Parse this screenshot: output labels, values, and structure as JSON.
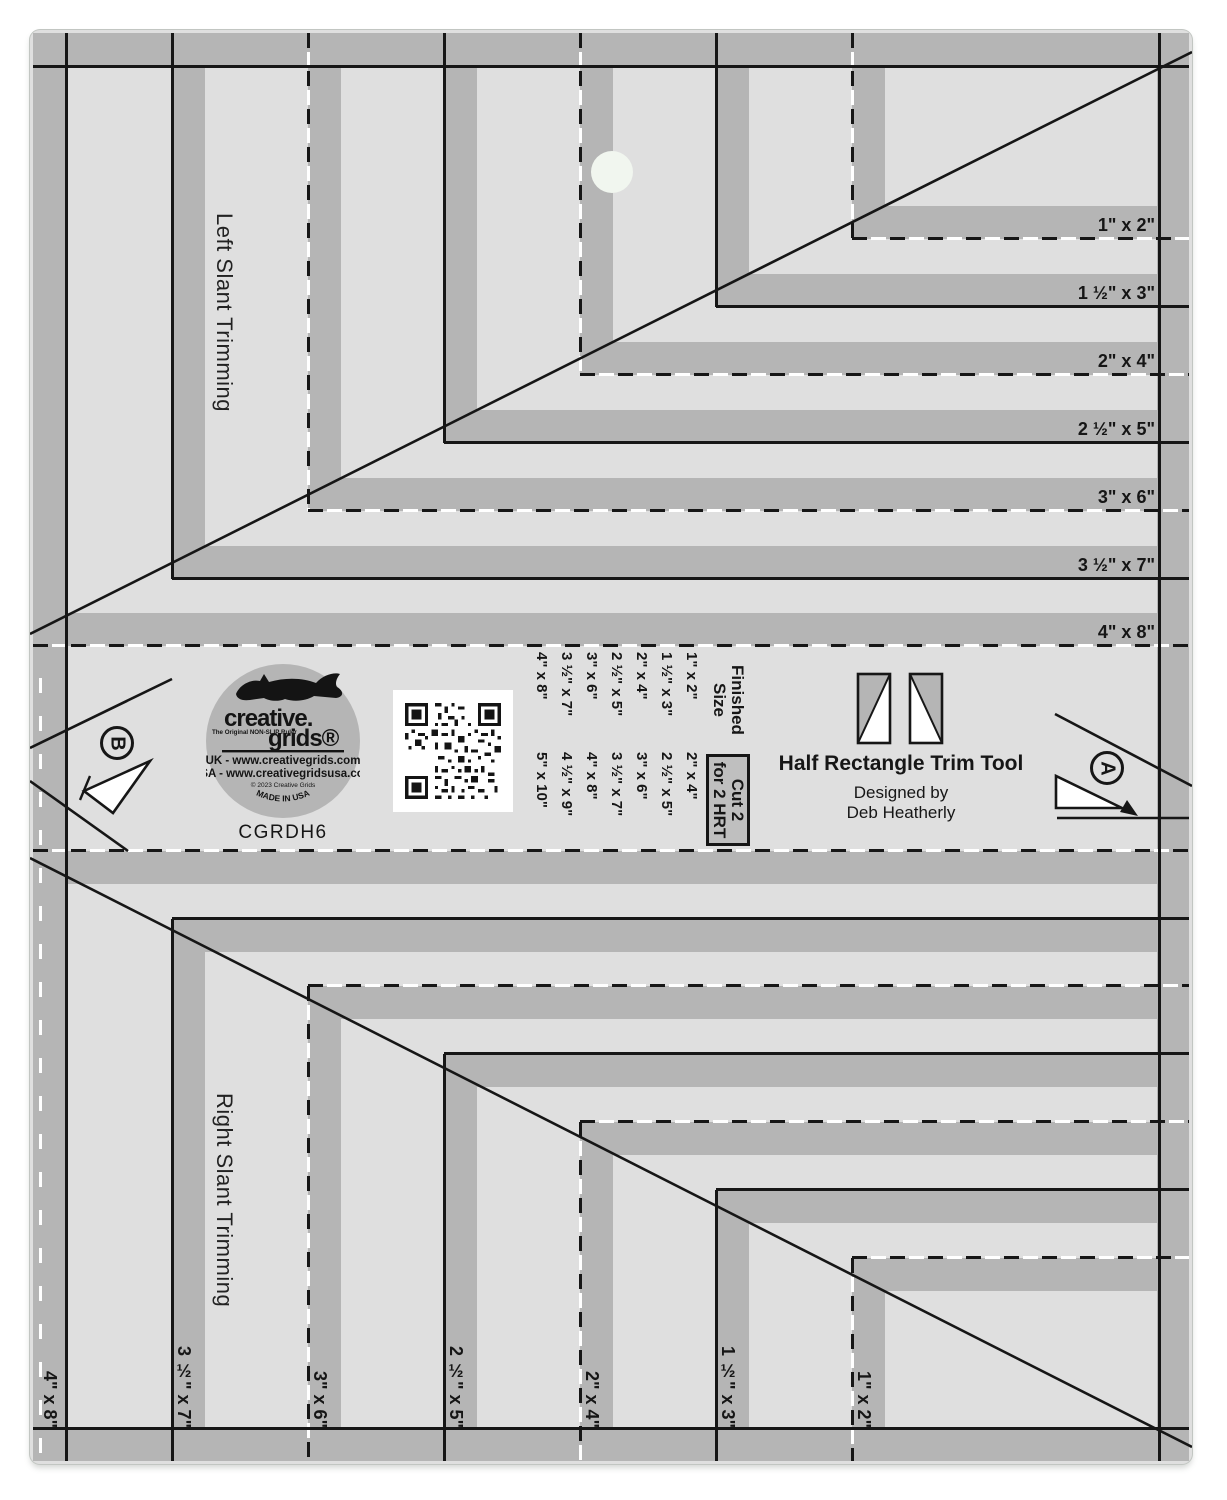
{
  "colors": {
    "body": "#dfdfdf",
    "band": "#b5b5b5",
    "line": "#161616",
    "white": "#ffffff",
    "hole": "#f1f6ef"
  },
  "sections": {
    "left_slant": "Left Slant Trimming",
    "right_slant": "Right Slant Trimming"
  },
  "markers": {
    "a": "A",
    "b": "B"
  },
  "top_labels": [
    "1\" x 2\"",
    "1 ½\" x 3\"",
    "2\" x 4\"",
    "2 ½\" x 5\"",
    "3\" x 6\"",
    "3 ½\" x 7\"",
    "4\" x 8\""
  ],
  "bottom_labels": [
    "4\" x 8\"",
    "3 ½\" x 7\"",
    "3\" x 6\"",
    "2 ½\" x 5\"",
    "2\" x 4\"",
    "1 ½\" x 3\"",
    "1\" x 2\""
  ],
  "branding": {
    "model": "CGRDH6",
    "brand_primary": "creative.",
    "brand_secondary": "grids®",
    "tagline": "The Original NON-SLIP Ruler",
    "uk_line": "UK - www.creativegrids.com",
    "usa_line": "USA - www.creativegridsusa.com",
    "copyright": "© 2023 Creative Grids",
    "made_in": "MADE IN USA"
  },
  "info": {
    "title": "Half Rectangle Trim Tool",
    "byline": "Designed by",
    "designer": "Deb Heatherly"
  },
  "size_table": {
    "finished_header_line1": "Finished",
    "finished_header_line2": "Size",
    "cut_header_line1": "Cut 2",
    "cut_header_line2": "for 2 HRT",
    "rows": [
      {
        "finished": "1\" x 2\"",
        "cut": "2\" x 4\""
      },
      {
        "finished": "1 ½\" x 3\"",
        "cut": "2 ½\" x 5\""
      },
      {
        "finished": "2\" x 4\"",
        "cut": "3\" x 6\""
      },
      {
        "finished": "2 ½\" x 5\"",
        "cut": "3 ½\" x 7\""
      },
      {
        "finished": "3\" x 6\"",
        "cut": "4\" x 8\""
      },
      {
        "finished": "3 ½\" x 7\"",
        "cut": "4 ½\" x 9\""
      },
      {
        "finished": "4\" x 8\"",
        "cut": "5\" x 10\""
      }
    ]
  }
}
